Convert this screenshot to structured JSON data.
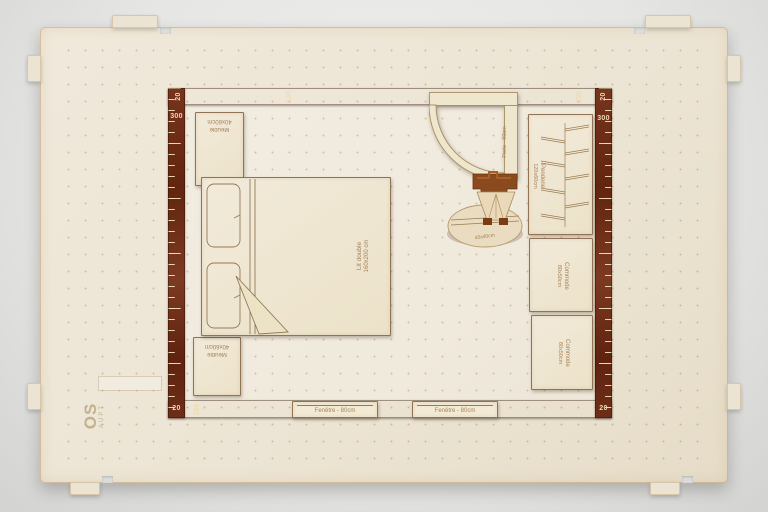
{
  "rulers": {
    "top": [
      "20",
      "100",
      "300",
      "20"
    ],
    "left": [
      "300",
      "20"
    ],
    "right": [
      "300",
      "20"
    ],
    "bottom": [
      "100"
    ]
  },
  "furniture": {
    "meuble_top": {
      "name": "Meuble",
      "size": "40x60cm"
    },
    "meuble_bottom": {
      "name": "Meuble",
      "size": "40x60cm"
    },
    "bed": {
      "name": "Lit double",
      "size": "160x200 cm"
    },
    "door": {
      "label": "Porte - 90cm"
    },
    "wardrobe": {
      "name": "Penderie",
      "size": "120x60cm"
    },
    "commode_top": {
      "name": "Commode",
      "size": "80x50cm"
    },
    "commode_bottom": {
      "name": "Commode",
      "size": "80x50cm"
    },
    "window_left": {
      "label": "Fenêtre - 80cm"
    },
    "window_right": {
      "label": "Fenêtre - 80cm"
    },
    "nightstand": {
      "disc_label": "40x40cm"
    }
  },
  "board_mark": {
    "big": "OS",
    "small": "AUPT"
  },
  "colors": {
    "ruler_wood": "#6e2d18",
    "board_wood": "#ece4d2",
    "piece_wood": "#f0e8d2",
    "engraving": "#a6825a",
    "backdrop": "#e6e6e4"
  }
}
